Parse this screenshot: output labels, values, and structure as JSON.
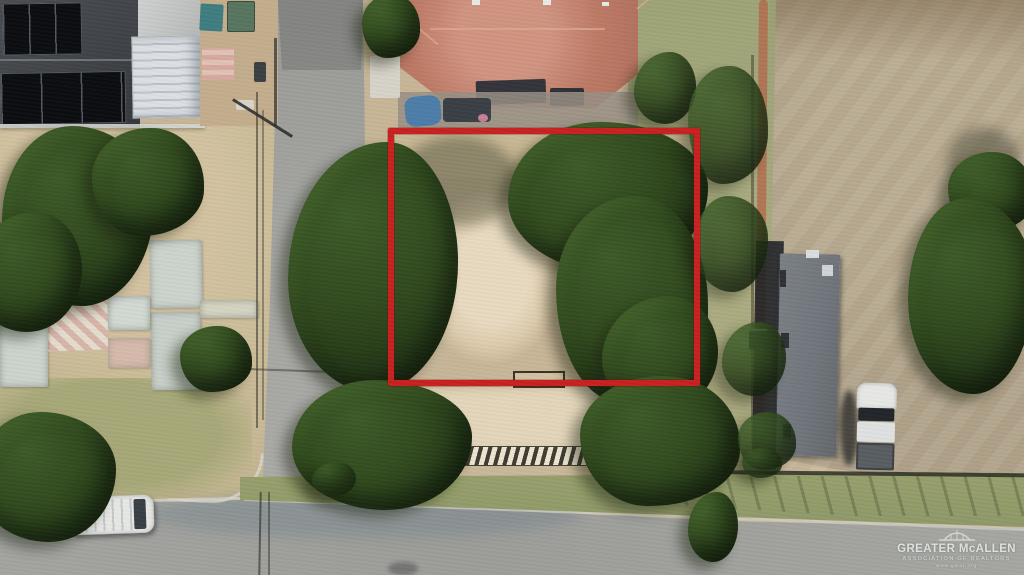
{
  "watermark": {
    "logo_icon": "mcallen-bridge-logo",
    "line1": "GREATER McALLEN",
    "line2": "ASSOCIATION OF REALTORS",
    "line3": "www.gmar.org"
  },
  "annotation": {
    "shape": "rectangle",
    "purpose": "property-boundary-outline"
  },
  "palette": {
    "boundary-red": "#c92121",
    "road-gray": "#9f9f9b",
    "dirt-tan": "#c6b496",
    "field-tan": "#b2a48b",
    "sand-light": "#e3d5ba",
    "dry-grass": "#bfb28d",
    "green-grass": "#8f9868",
    "tree-dark": "#223516",
    "tree-mid": "#3c5a28",
    "roof-terracotta": "#bd7a66",
    "roof-dark": "#3f4347",
    "solar-black": "#0b0d10",
    "metal-white": "#dce0e3",
    "trailer-gray": "#70757b",
    "vehicle-white": "#e7e8e6",
    "slab-gray": "#ccd3cd",
    "watermark-white": "#e6e9e6"
  }
}
